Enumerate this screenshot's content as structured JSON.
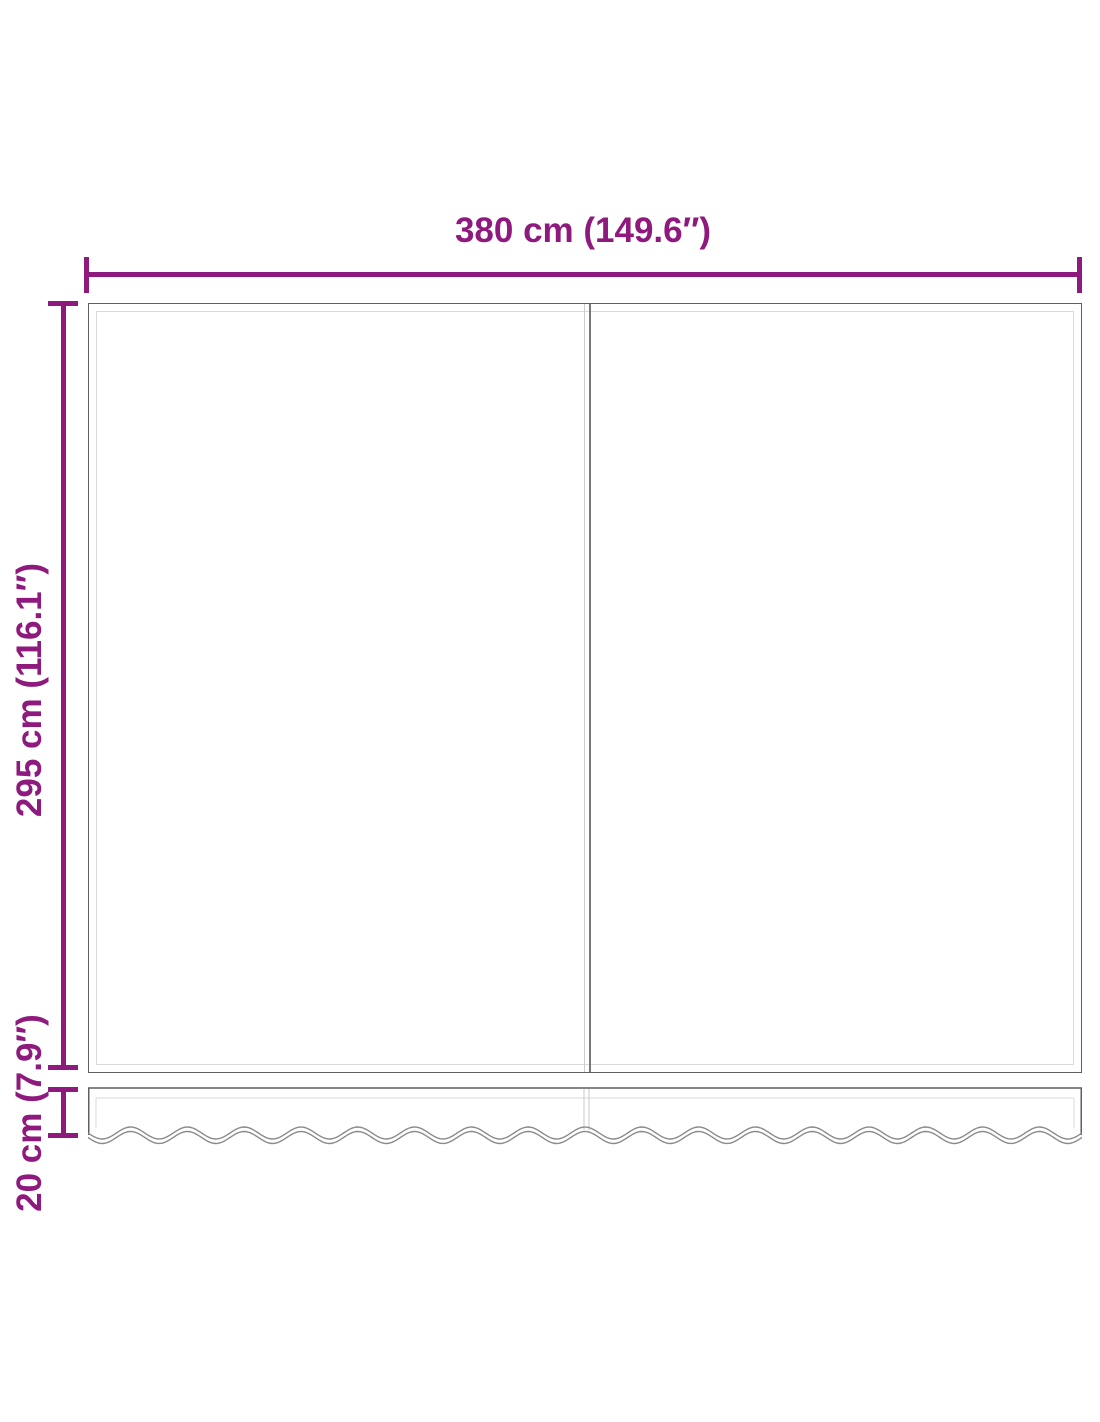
{
  "diagram": {
    "type": "product dimension drawing",
    "subject": "replacement awning fabric with wavy valance, two panels",
    "accent_color": "#8E1A7E",
    "outline_color": "#5F5F5F",
    "light_line_color": "#D9D9D9",
    "dimensions": {
      "width": {
        "cm": "380",
        "inches": "149.6",
        "label": "380 cm (149.6″)"
      },
      "height": {
        "cm": "295",
        "inches": "116.1",
        "label": "295 cm (116.1″)"
      },
      "valance": {
        "cm": "20",
        "inches": "7.9",
        "label": "20 cm (7.9″)"
      }
    }
  }
}
